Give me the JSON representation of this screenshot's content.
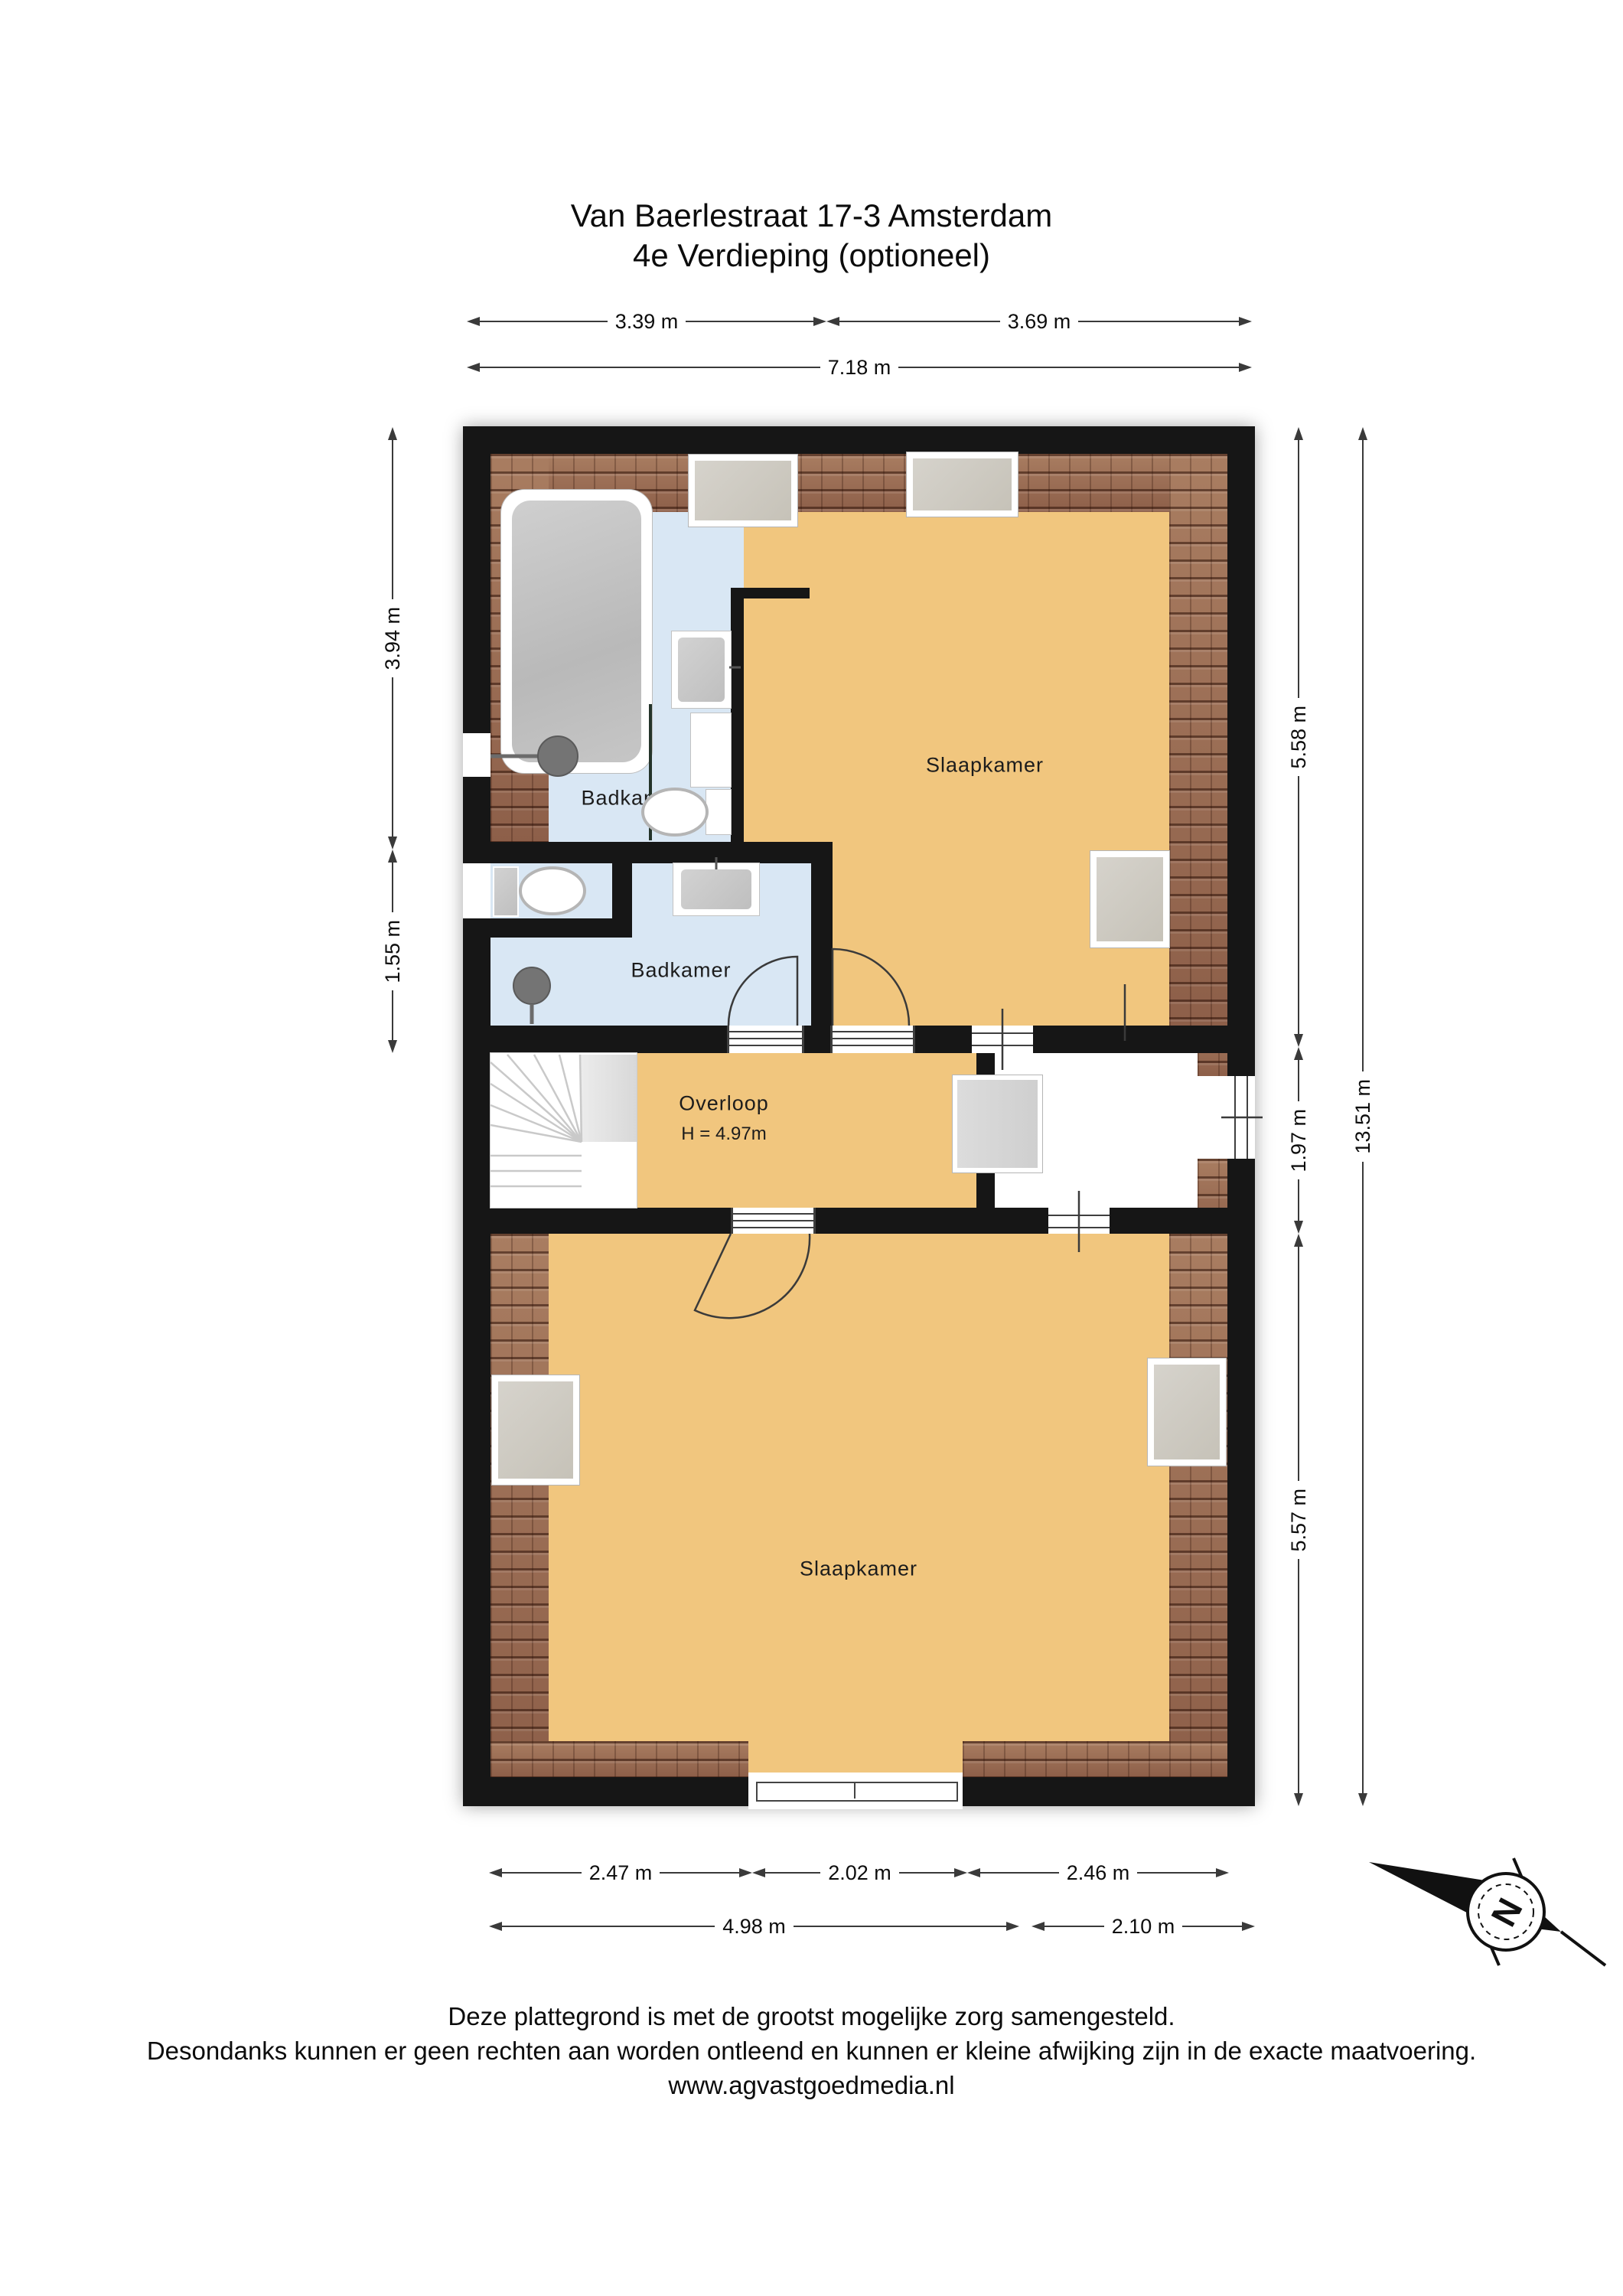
{
  "title": {
    "line1": "Van Baerlestraat 17-3 Amsterdam",
    "line2": "4e Verdieping (optioneel)"
  },
  "rooms": {
    "bathroom_top": "Badkamer",
    "bedroom_top": "Slaapkamer",
    "bathroom_mid": "Badkamer",
    "landing": "Overloop",
    "landing_height": "H = 4.97m",
    "bedroom_bottom": "Slaapkamer"
  },
  "dimensions": {
    "top_left": "3.39 m",
    "top_right": "3.69 m",
    "top_total": "7.18 m",
    "left_upper": "3.94 m",
    "left_lower": "1.55 m",
    "right_upper": "5.58 m",
    "right_middle": "1.97 m",
    "right_lower": "5.57 m",
    "right_total": "13.51 m",
    "bottom_left": "2.47 m",
    "bottom_center": "2.02 m",
    "bottom_right": "2.46 m",
    "bottom_total_left": "4.98 m",
    "bottom_total_right": "2.10 m"
  },
  "compass": {
    "north": "N"
  },
  "footer": {
    "line1": "Deze plattegrond is met de grootst mogelijke zorg samengesteld.",
    "line2": "Desondanks kunnen er geen rechten aan worden ontleend en kunnen er kleine afwijking zijn in de exacte maatvoering.",
    "line3": "www.agvastgoedmedia.nl"
  },
  "colors": {
    "wall": "#161616",
    "floor_warm": "#f1c67e",
    "floor_bath": "#d9e7f4",
    "roof_tile": "#9b6b53",
    "fixture_grey": "#c9c9c9"
  }
}
